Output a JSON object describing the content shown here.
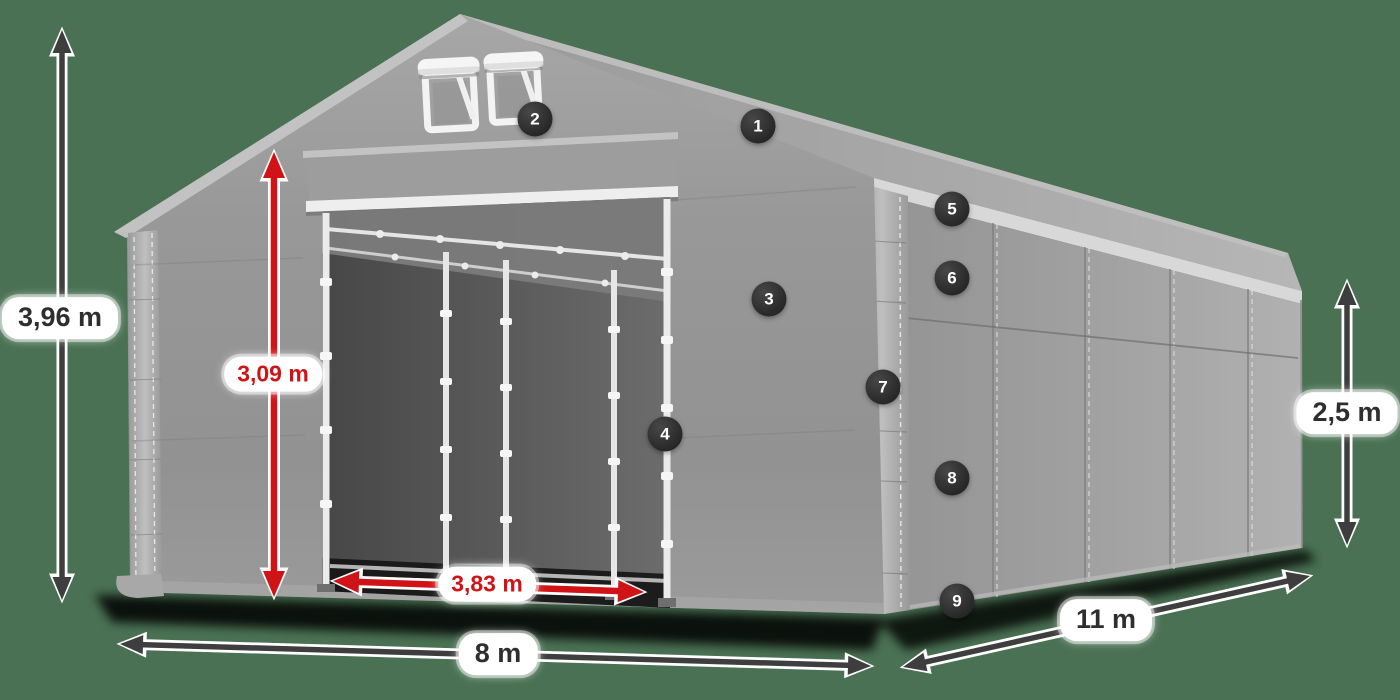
{
  "scene": {
    "background_color": "#4a7153",
    "arrow_dark_color": "#3e3e3e",
    "arrow_red_color": "#d01317",
    "label_bg": "#ffffff",
    "label_dark_text": "#2e2e2e",
    "label_red_text": "#d01317",
    "badge_bg": "#1f1f1f",
    "badge_text": "#ffffff"
  },
  "dimensions": [
    {
      "id": "total-height",
      "label": "3,96 m",
      "style": "dark",
      "size": "lg",
      "x1": 62,
      "y1": 30,
      "x2": 62,
      "y2": 600,
      "lx": 60,
      "ly": 318
    },
    {
      "id": "door-height",
      "label": "3,09 m",
      "style": "red",
      "size": "md",
      "x1": 274,
      "y1": 152,
      "x2": 274,
      "y2": 597,
      "lx": 273,
      "ly": 374
    },
    {
      "id": "door-width",
      "label": "3,83 m",
      "style": "red",
      "size": "md",
      "x1": 333,
      "y1": 581,
      "x2": 644,
      "y2": 592,
      "lx": 487,
      "ly": 584
    },
    {
      "id": "ground-width",
      "label": "8 m",
      "style": "dark",
      "size": "lg",
      "x1": 120,
      "y1": 644,
      "x2": 871,
      "y2": 666,
      "lx": 498,
      "ly": 654
    },
    {
      "id": "ground-length",
      "label": "11 m",
      "style": "dark",
      "size": "lg",
      "x1": 903,
      "y1": 667,
      "x2": 1310,
      "y2": 576,
      "lx": 1106,
      "ly": 620
    },
    {
      "id": "side-height",
      "label": "2,5 m",
      "style": "dark",
      "size": "lg",
      "x1": 1347,
      "y1": 282,
      "x2": 1347,
      "y2": 545,
      "lx": 1347,
      "ly": 413
    }
  ],
  "callouts": [
    {
      "number": "1",
      "x": 758,
      "y": 126
    },
    {
      "number": "2",
      "x": 535,
      "y": 119
    },
    {
      "number": "3",
      "x": 769,
      "y": 299
    },
    {
      "number": "4",
      "x": 665,
      "y": 434
    },
    {
      "number": "5",
      "x": 952,
      "y": 209
    },
    {
      "number": "6",
      "x": 952,
      "y": 278
    },
    {
      "number": "7",
      "x": 883,
      "y": 387
    },
    {
      "number": "8",
      "x": 952,
      "y": 478
    },
    {
      "number": "9",
      "x": 957,
      "y": 601
    }
  ]
}
